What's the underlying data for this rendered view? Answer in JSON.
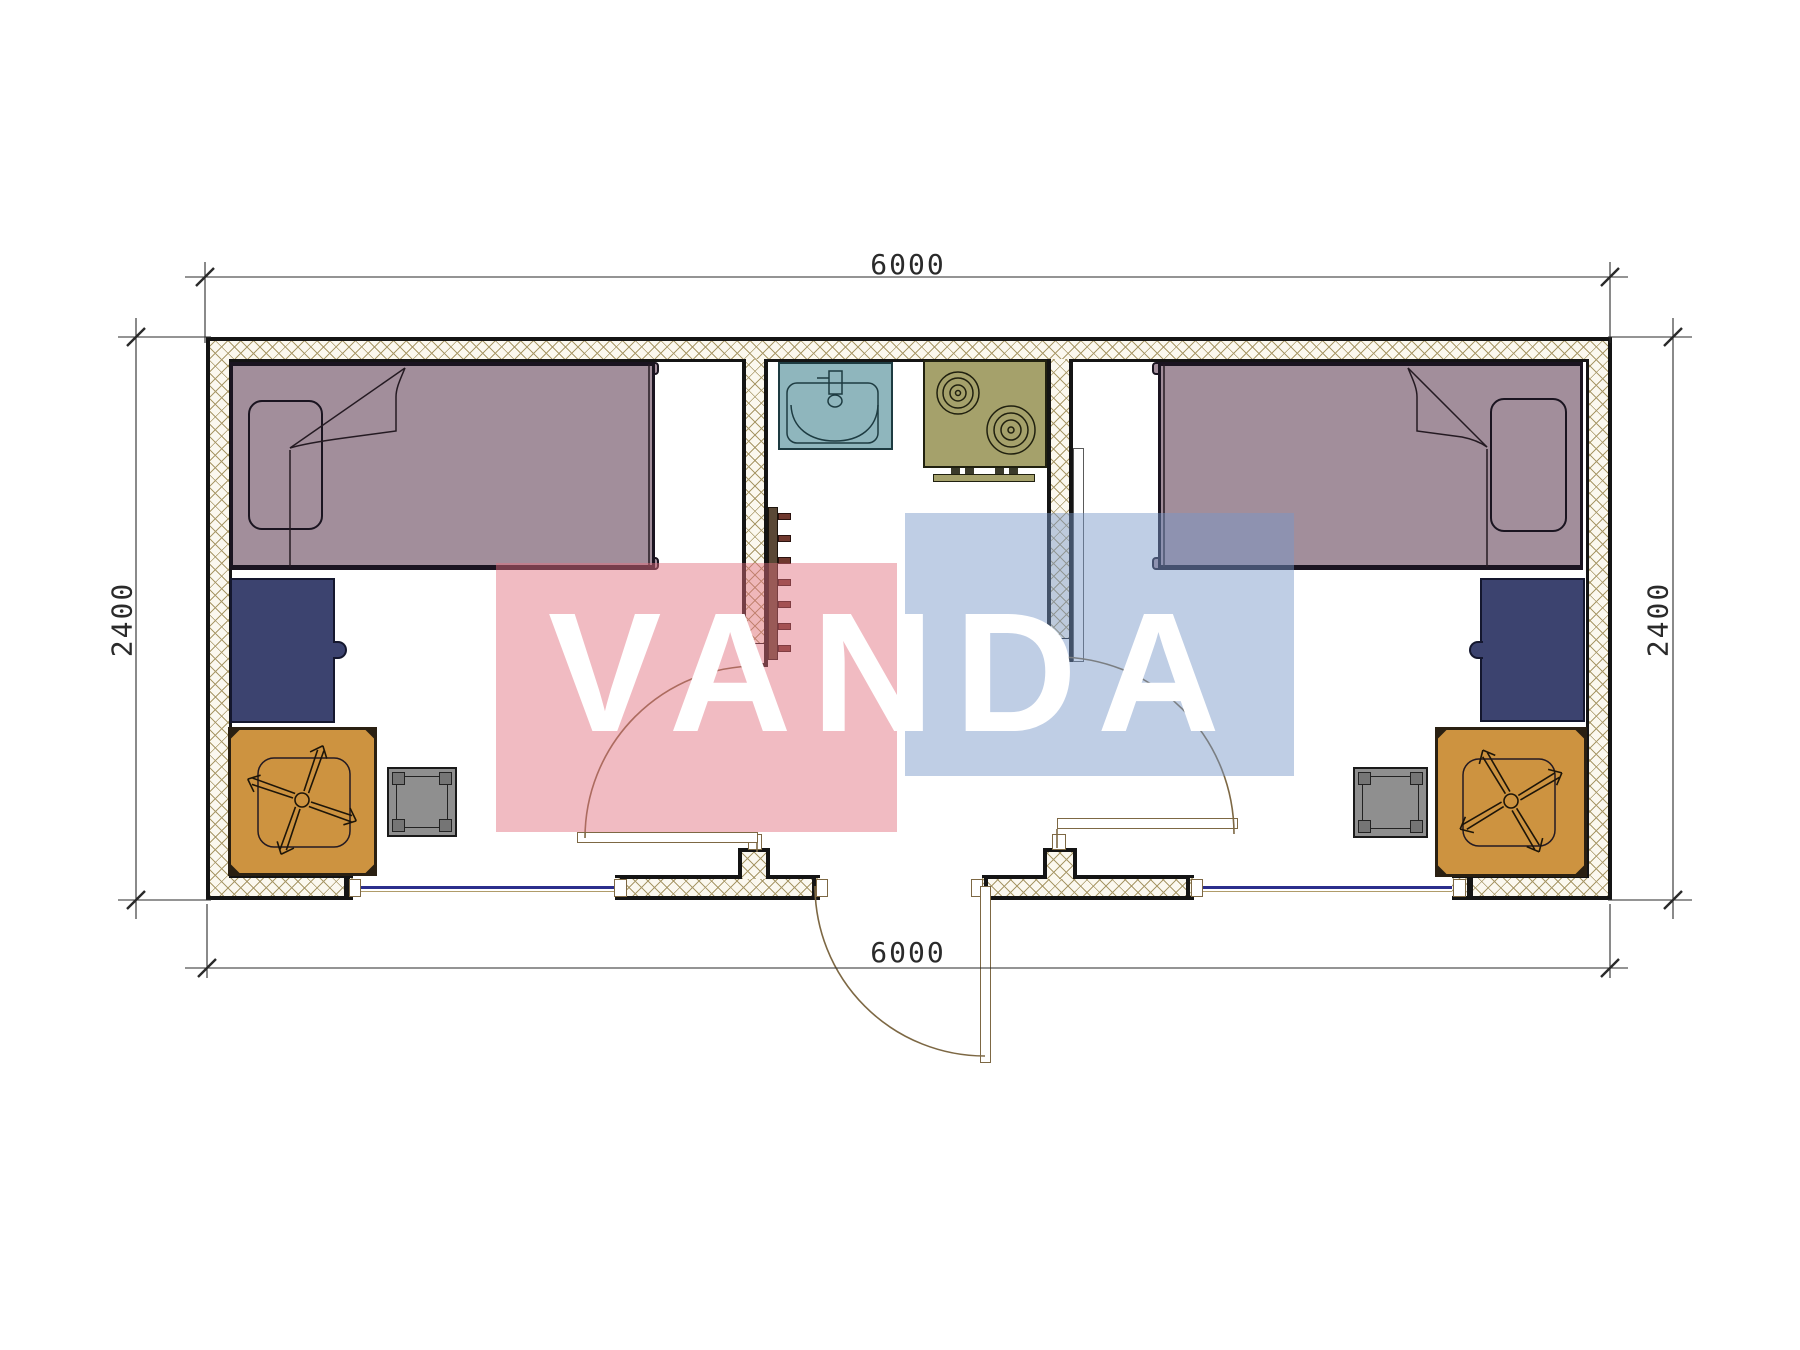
{
  "drawing": {
    "type": "container-house-floor-plan",
    "dimensions": {
      "top": "6000",
      "bottom": "6000",
      "left": "2400",
      "right": "2400"
    },
    "watermark": {
      "text": "VANDA"
    }
  },
  "colors": {
    "wall-line": "#141414",
    "hatch-bg": "#fbf8ef",
    "hatch-line": "#a89868",
    "bed": "#a28e9b",
    "bed-line": "#1a1420",
    "desk": "#3c436f",
    "table": "#cd9340",
    "table-line": "#2a2012",
    "stool": "#8f8f8f",
    "sink": "#8fb6bd",
    "sink-line": "#1d3b41",
    "stove": "#a5a16b",
    "stove-line": "#20200f",
    "ladder-bar": "#5a4836",
    "ladder-rung": "#6f382e",
    "window-blue": "#2b2e8c",
    "window-tan": "#b09c6a",
    "door-line": "#7d6844",
    "dim-line": "#2a2a2a",
    "wm-pink": "#e16e7d",
    "wm-blue": "#7896c8"
  }
}
